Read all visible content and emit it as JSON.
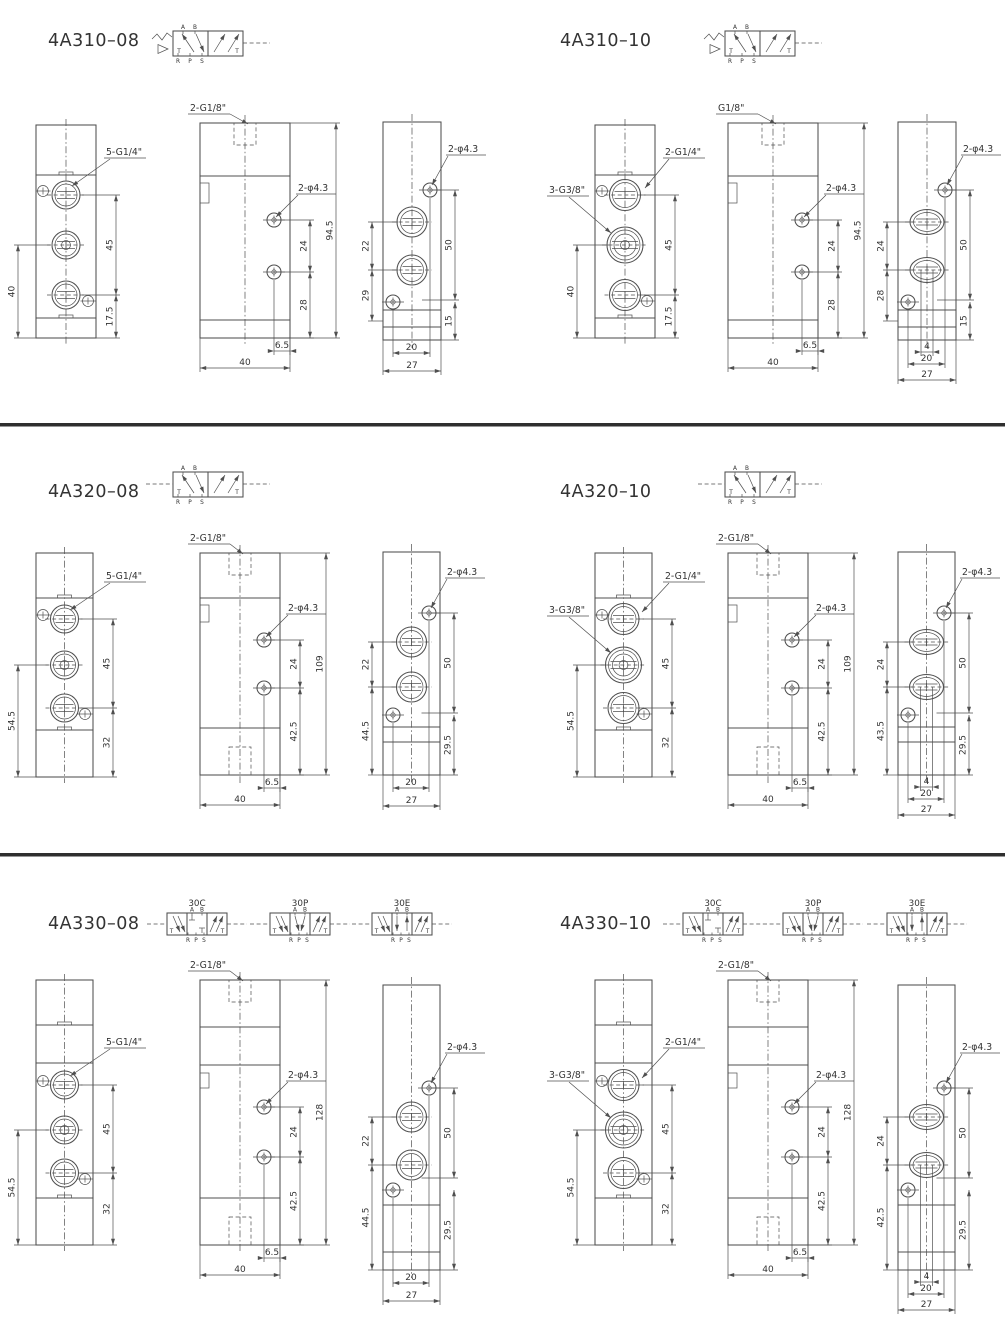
{
  "page": {
    "background": "#ffffff",
    "line_color": "#4f4f4f",
    "text_color": "#333333",
    "divider_color": "#2f2f2f"
  },
  "panels": [
    {
      "title": "4A310–08",
      "symbol": {
        "type": "5/2 single pilot spring return",
        "variants": [],
        "top_labels": [
          "A",
          "B"
        ],
        "bottom_labels": [
          "R",
          "P",
          "S"
        ],
        "corner_labels": [
          "T",
          "T"
        ]
      },
      "front_view": {
        "port_label": "5-G1/4\"",
        "port_label2": null,
        "dim_right_top": "45",
        "dim_right_bottom": "17.5",
        "dim_left": "40"
      },
      "side_view": {
        "top_port_label": "2-G1/8\"",
        "hole_label": "2-φ4.3",
        "dim_hole_gap": "24",
        "dim_hole_to_bottom": "28",
        "dim_height": "94.5",
        "dim_hole_offset": "6.5",
        "dim_width": "40"
      },
      "end_view": {
        "hole_label": "2-φ4.3",
        "dim_left_top": "22",
        "dim_left_bottom": "29",
        "dim_right_top": "50",
        "dim_right_bottom": "15",
        "dim_bottom_inner": null,
        "dim_bottom_mid": "20",
        "dim_bottom_outer": "27"
      }
    },
    {
      "title": "4A310–10",
      "symbol": {
        "type": "5/2 single pilot spring return",
        "variants": [],
        "top_labels": [
          "A",
          "B"
        ],
        "bottom_labels": [
          "R",
          "P",
          "S"
        ],
        "corner_labels": [
          "T",
          "T"
        ]
      },
      "front_view": {
        "port_label": "2-G1/4\"",
        "port_label2": "3-G3/8\"",
        "dim_right_top": "45",
        "dim_right_bottom": "17.5",
        "dim_left": "40"
      },
      "side_view": {
        "top_port_label": "G1/8\"",
        "hole_label": "2-φ4.3",
        "dim_hole_gap": "24",
        "dim_hole_to_bottom": "28",
        "dim_height": "94.5",
        "dim_hole_offset": "6.5",
        "dim_width": "40"
      },
      "end_view": {
        "hole_label": "2-φ4.3",
        "dim_left_top": "24",
        "dim_left_bottom": "28",
        "dim_right_top": "50",
        "dim_right_bottom": "15",
        "dim_bottom_inner": "4",
        "dim_bottom_mid": "20",
        "dim_bottom_outer": "27"
      }
    },
    {
      "title": "4A320–08",
      "symbol": {
        "type": "5/2 double pilot",
        "variants": [],
        "top_labels": [
          "A",
          "B"
        ],
        "bottom_labels": [
          "R",
          "P",
          "S"
        ],
        "corner_labels": [
          "T",
          "T"
        ]
      },
      "front_view": {
        "port_label": "5-G1/4\"",
        "port_label2": null,
        "dim_right_top": "45",
        "dim_right_bottom": "32",
        "dim_left": "54.5"
      },
      "side_view": {
        "top_port_label": "2-G1/8\"",
        "hole_label": "2-φ4.3",
        "dim_hole_gap": "24",
        "dim_hole_to_bottom": "42.5",
        "dim_height": "109",
        "dim_hole_offset": "6.5",
        "dim_width": "40"
      },
      "end_view": {
        "hole_label": "2-φ4.3",
        "dim_left_top": "22",
        "dim_left_bottom": "44.5",
        "dim_right_top": "50",
        "dim_right_bottom": "29.5",
        "dim_bottom_inner": null,
        "dim_bottom_mid": "20",
        "dim_bottom_outer": "27"
      }
    },
    {
      "title": "4A320–10",
      "symbol": {
        "type": "5/2 double pilot",
        "variants": [],
        "top_labels": [
          "A",
          "B"
        ],
        "bottom_labels": [
          "R",
          "P",
          "S"
        ],
        "corner_labels": [
          "T",
          "T"
        ]
      },
      "front_view": {
        "port_label": "2-G1/4\"",
        "port_label2": "3-G3/8\"",
        "dim_right_top": "45",
        "dim_right_bottom": "32",
        "dim_left": "54.5"
      },
      "side_view": {
        "top_port_label": "2-G1/8\"",
        "hole_label": "2-φ4.3",
        "dim_hole_gap": "24",
        "dim_hole_to_bottom": "42.5",
        "dim_height": "109",
        "dim_hole_offset": "6.5",
        "dim_width": "40"
      },
      "end_view": {
        "hole_label": "2-φ4.3",
        "dim_left_top": "24",
        "dim_left_bottom": "43.5",
        "dim_right_top": "50",
        "dim_right_bottom": "29.5",
        "dim_bottom_inner": "4",
        "dim_bottom_mid": "20",
        "dim_bottom_outer": "27"
      }
    },
    {
      "title": "4A330–08",
      "symbol": {
        "type": "5/3 double pilot",
        "variants": [
          "30C",
          "30P",
          "30E"
        ],
        "top_labels": [
          "A",
          "B"
        ],
        "bottom_labels": [
          "R",
          "P",
          "S"
        ],
        "corner_labels": [
          "T",
          "T"
        ]
      },
      "front_view": {
        "port_label": "5-G1/4\"",
        "port_label2": null,
        "dim_right_top": "45",
        "dim_right_bottom": "32",
        "dim_left": "54.5"
      },
      "side_view": {
        "top_port_label": "2-G1/8\"",
        "hole_label": "2-φ4.3",
        "dim_hole_gap": "24",
        "dim_hole_to_bottom": "42.5",
        "dim_height": "128",
        "dim_hole_offset": "6.5",
        "dim_width": "40"
      },
      "end_view": {
        "hole_label": "2-φ4.3",
        "dim_left_top": "22",
        "dim_left_bottom": "44.5",
        "dim_right_top": "50",
        "dim_right_bottom": "29.5",
        "dim_bottom_inner": null,
        "dim_bottom_mid": "20",
        "dim_bottom_outer": "27"
      }
    },
    {
      "title": "4A330–10",
      "symbol": {
        "type": "5/3 double pilot",
        "variants": [
          "30C",
          "30P",
          "30E"
        ],
        "top_labels": [
          "A",
          "B"
        ],
        "bottom_labels": [
          "R",
          "P",
          "S"
        ],
        "corner_labels": [
          "T",
          "T"
        ]
      },
      "front_view": {
        "port_label": "2-G1/4\"",
        "port_label2": "3-G3/8\"",
        "dim_right_top": "45",
        "dim_right_bottom": "32",
        "dim_left": "54.5"
      },
      "side_view": {
        "top_port_label": "2-G1/8\"",
        "hole_label": "2-φ4.3",
        "dim_hole_gap": "24",
        "dim_hole_to_bottom": "42.5",
        "dim_height": "128",
        "dim_hole_offset": "6.5",
        "dim_width": "40"
      },
      "end_view": {
        "hole_label": "2-φ4.3",
        "dim_left_top": "24",
        "dim_left_bottom": "42.5",
        "dim_right_top": "50",
        "dim_right_bottom": "29.5",
        "dim_bottom_inner": "4",
        "dim_bottom_mid": "20",
        "dim_bottom_outer": "27"
      }
    }
  ]
}
